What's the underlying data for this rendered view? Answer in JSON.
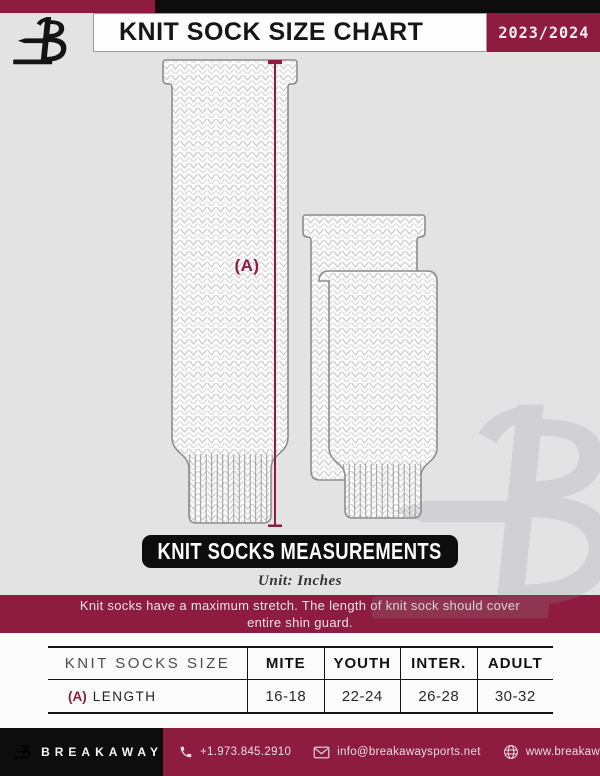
{
  "header": {
    "title": "KNIT SOCK SIZE CHART",
    "season": "2023/2024"
  },
  "diagram": {
    "dimension_label": "(A)",
    "measurements_banner": "KNIT SOCKS MEASUREMENTS",
    "unit_note": "Unit: Inches",
    "stretch_note": {
      "line1": "Knit socks have a maximum stretch. The length of knit sock should cover",
      "line2": "entire shin guard."
    }
  },
  "table": {
    "size_column_header": "KNIT SOCKS SIZE",
    "columns": [
      "MITE",
      "YOUTH",
      "INTER.",
      "ADULT"
    ],
    "rows": [
      {
        "dimension": "(A)",
        "label": "LENGTH",
        "values": [
          "16-18",
          "22-24",
          "26-28",
          "30-32"
        ]
      }
    ]
  },
  "footer": {
    "brand": "BREAKAWAY",
    "phone": "+1.973.845.2910",
    "email": "info@breakawaysports.net",
    "website": "www.breakawaysports.net"
  },
  "colors": {
    "maroon": "#8e1c40",
    "black": "#0d0d0d",
    "page_gray": "#e4e3e4",
    "sock_outline": "#8d8d8d",
    "knit_stroke": "#c9c9cc",
    "footer_text": "#e9dce0"
  },
  "chart_data": {
    "type": "table",
    "title": "KNIT SOCK SIZE CHART",
    "unit": "Inches",
    "columns": [
      "MITE",
      "YOUTH",
      "INTER.",
      "ADULT"
    ],
    "rows": [
      {
        "measurement": "(A) LENGTH",
        "values": [
          "16-18",
          "22-24",
          "26-28",
          "30-32"
        ]
      }
    ]
  }
}
